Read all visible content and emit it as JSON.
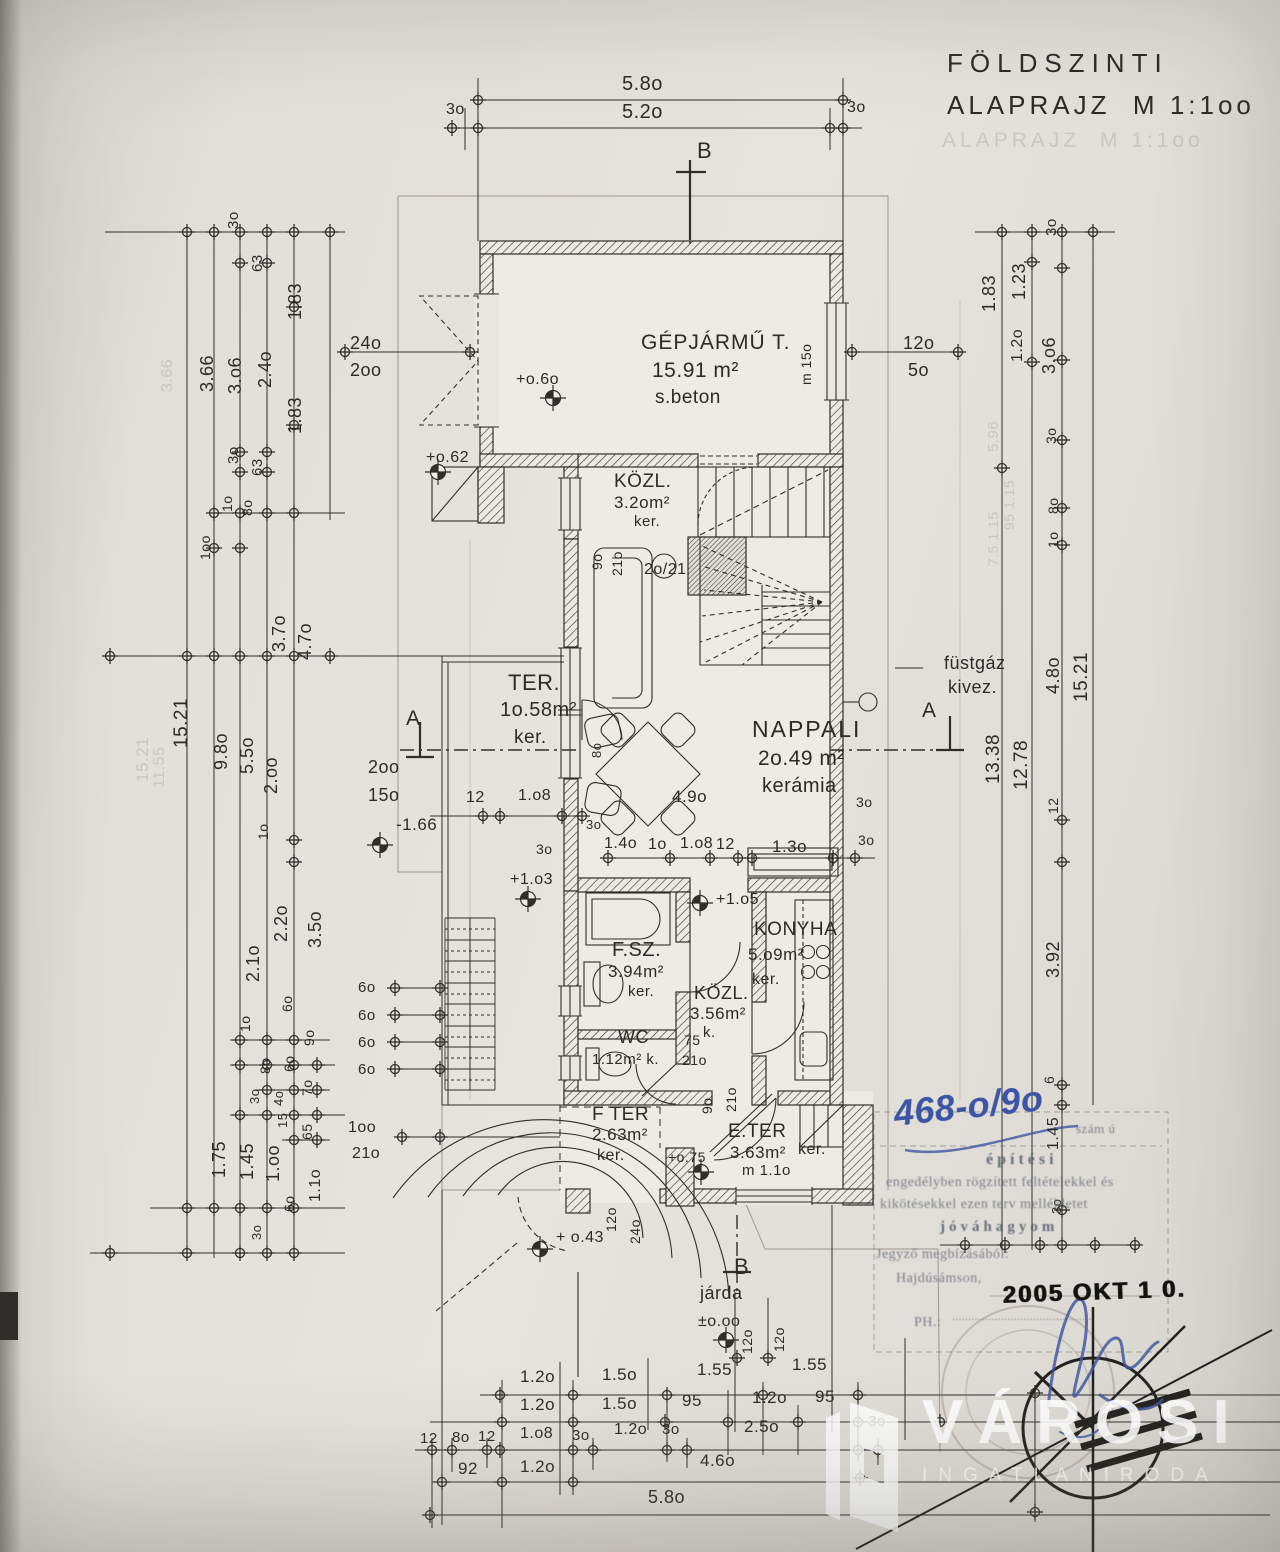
{
  "document": {
    "type": "scanned floor plan",
    "title_line1": "FÖLDSZINTI",
    "title_line2": "ALAPRAJZ  M 1:1oo",
    "scale": "M 1:1oo"
  },
  "rooms": [
    {
      "name": "GÉPJÁRMŰ T.",
      "area": "15.91 m²",
      "floor": "s.beton"
    },
    {
      "name": "KÖZL.",
      "area": "3.2o m²",
      "floor": "ker."
    },
    {
      "name": "TER.",
      "area": "1o.58 m²",
      "floor": "ker."
    },
    {
      "name": "NAPPALI",
      "area": "2o.49 m²",
      "floor": "kerámia"
    },
    {
      "name": "F.SZ.",
      "area": "3.94 m²",
      "floor": "ker."
    },
    {
      "name": "WC",
      "area": "1.12 m²",
      "floor": "k."
    },
    {
      "name": "KÖZL.",
      "area": "3.56 m²",
      "floor": "k."
    },
    {
      "name": "KONYHA",
      "area": "5.o9 m²",
      "floor": "ker."
    },
    {
      "name": "F TER",
      "area": "2.63 m²",
      "floor": "ker."
    },
    {
      "name": "E.TER",
      "area": "3.63 m²",
      "floor": "ker."
    }
  ],
  "levels": [
    "+o.6o",
    "+o.62",
    "+1.o3",
    "+1.o5",
    "+o.75",
    "+ o.43",
    "±o.oo",
    "-1.66"
  ],
  "annotations": [
    "füstgáz kivez.",
    "járda",
    "2o/21",
    "m 15o",
    "m 1.1o"
  ],
  "stamp": {
    "faint_ref": "szám ú",
    "lines": [
      "építési",
      "engedélyben rögzített feltételekkel és",
      "kikötésekkel ezen terv mellékletet",
      "jóváhagyom"
    ],
    "issuer": "Jegyző megbízásából:",
    "city": "Hajdúsámson,",
    "ph": "PH.:",
    "seal_date": "2005 OKT 1 0."
  },
  "handwriting": {
    "file_number": "468-o/9o"
  },
  "watermark": {
    "brand": "VÁROSI",
    "subtitle": "INGATLANIRODA"
  },
  "labels": [
    {
      "t": "FÖLDSZINTI",
      "x": 947,
      "y": 50,
      "s": 26,
      "ls": 7,
      "c": "tt",
      "n": "title-line-1"
    },
    {
      "t": "ALAPRAJZ  M 1:1oo",
      "x": 947,
      "y": 92,
      "s": 26,
      "ls": 4,
      "c": "tt",
      "n": "title-line-2"
    },
    {
      "t": "ALAPRAJZ  M 1:1oo",
      "x": 942,
      "y": 130,
      "s": 21,
      "ls": 4,
      "c": "g2"
    },
    {
      "t": "5.8o",
      "x": 622,
      "y": 74,
      "s": 20
    },
    {
      "t": "3o",
      "x": 446,
      "y": 102,
      "s": 16
    },
    {
      "t": "5.2o",
      "x": 622,
      "y": 102,
      "s": 20
    },
    {
      "t": "3o",
      "x": 847,
      "y": 100,
      "s": 16
    },
    {
      "t": "B",
      "x": 697,
      "y": 140,
      "s": 22
    },
    {
      "t": "GÉPJÁRMŰ T.",
      "x": 641,
      "y": 332,
      "s": 21,
      "ls": 1
    },
    {
      "t": "15.91 m²",
      "x": 652,
      "y": 360,
      "s": 21
    },
    {
      "t": "s.beton",
      "x": 655,
      "y": 388,
      "s": 19
    },
    {
      "t": "+o.6o",
      "x": 516,
      "y": 372,
      "s": 16
    },
    {
      "t": "+o.62",
      "x": 426,
      "y": 450,
      "s": 16
    },
    {
      "t": "24o",
      "x": 350,
      "y": 334,
      "s": 18
    },
    {
      "t": "2oo",
      "x": 350,
      "y": 361,
      "s": 18
    },
    {
      "t": "12o",
      "x": 903,
      "y": 334,
      "s": 18
    },
    {
      "t": "5o",
      "x": 908,
      "y": 361,
      "s": 18
    },
    {
      "t": "m 15o",
      "x": 799,
      "y": 385,
      "s": 14,
      "r": -90
    },
    {
      "t": "3o",
      "x": 226,
      "y": 229,
      "s": 15,
      "r": -90
    },
    {
      "t": "63",
      "x": 250,
      "y": 272,
      "s": 15,
      "r": -90
    },
    {
      "t": "1.83",
      "x": 286,
      "y": 320,
      "s": 18,
      "r": -90
    },
    {
      "t": "3.66",
      "x": 198,
      "y": 392,
      "s": 18,
      "r": -90
    },
    {
      "t": "3.o6",
      "x": 226,
      "y": 394,
      "s": 18,
      "r": -90
    },
    {
      "t": "2.4o",
      "x": 256,
      "y": 388,
      "s": 18,
      "r": -90
    },
    {
      "t": "1.83",
      "x": 286,
      "y": 434,
      "s": 18,
      "r": -90
    },
    {
      "t": "3o",
      "x": 226,
      "y": 464,
      "s": 15,
      "r": -90
    },
    {
      "t": "63",
      "x": 250,
      "y": 476,
      "s": 15,
      "r": -90
    },
    {
      "t": "1o",
      "x": 220,
      "y": 512,
      "s": 14,
      "r": -90
    },
    {
      "t": "8o",
      "x": 240,
      "y": 516,
      "s": 14,
      "r": -90
    },
    {
      "t": "1oo",
      "x": 198,
      "y": 560,
      "s": 14,
      "r": -90
    },
    {
      "t": "3.7o",
      "x": 270,
      "y": 652,
      "s": 18,
      "r": -90
    },
    {
      "t": "4.7o",
      "x": 296,
      "y": 660,
      "s": 18,
      "r": -90
    },
    {
      "t": "15.21",
      "x": 172,
      "y": 748,
      "s": 19,
      "r": -90
    },
    {
      "t": "9.8o",
      "x": 212,
      "y": 770,
      "s": 18,
      "r": -90
    },
    {
      "t": "5.5o",
      "x": 238,
      "y": 774,
      "s": 18,
      "r": -90
    },
    {
      "t": "2.oo",
      "x": 262,
      "y": 794,
      "s": 18,
      "r": -90
    },
    {
      "t": "1o",
      "x": 256,
      "y": 840,
      "s": 14,
      "r": -90
    },
    {
      "t": "2.2o",
      "x": 272,
      "y": 942,
      "s": 18,
      "r": -90
    },
    {
      "t": "3.5o",
      "x": 306,
      "y": 948,
      "s": 18,
      "r": -90
    },
    {
      "t": "2.1o",
      "x": 244,
      "y": 982,
      "s": 18,
      "r": -90
    },
    {
      "t": "6o",
      "x": 280,
      "y": 1012,
      "s": 14,
      "r": -90
    },
    {
      "t": "1o",
      "x": 238,
      "y": 1032,
      "s": 14,
      "r": -90
    },
    {
      "t": "9o",
      "x": 302,
      "y": 1046,
      "s": 14,
      "r": -90
    },
    {
      "t": "8o",
      "x": 258,
      "y": 1074,
      "s": 14,
      "r": -90
    },
    {
      "t": "6o",
      "x": 282,
      "y": 1072,
      "s": 14,
      "r": -90
    },
    {
      "t": "3o",
      "x": 248,
      "y": 1104,
      "s": 13,
      "r": -90
    },
    {
      "t": "4o",
      "x": 272,
      "y": 1106,
      "s": 13,
      "r": -90
    },
    {
      "t": "7o",
      "x": 300,
      "y": 1096,
      "s": 14,
      "r": -90
    },
    {
      "t": "15",
      "x": 276,
      "y": 1128,
      "s": 13,
      "r": -90
    },
    {
      "t": "65",
      "x": 300,
      "y": 1140,
      "s": 14,
      "r": -90
    },
    {
      "t": "1.75",
      "x": 210,
      "y": 1178,
      "s": 18,
      "r": -90
    },
    {
      "t": "1.45",
      "x": 238,
      "y": 1180,
      "s": 18,
      "r": -90
    },
    {
      "t": "1.oo",
      "x": 264,
      "y": 1182,
      "s": 18,
      "r": -90
    },
    {
      "t": "6o",
      "x": 282,
      "y": 1212,
      "s": 14,
      "r": -90
    },
    {
      "t": "1.1o",
      "x": 308,
      "y": 1202,
      "s": 16,
      "r": -90
    },
    {
      "t": "3o",
      "x": 250,
      "y": 1240,
      "s": 13,
      "r": -90
    },
    {
      "t": "2oo",
      "x": 368,
      "y": 758,
      "s": 18
    },
    {
      "t": "15o",
      "x": 368,
      "y": 786,
      "s": 18
    },
    {
      "t": "12",
      "x": 466,
      "y": 790,
      "s": 16
    },
    {
      "t": "1.o8",
      "x": 518,
      "y": 788,
      "s": 16
    },
    {
      "t": "-1.66",
      "x": 396,
      "y": 816,
      "s": 17
    },
    {
      "t": "3o",
      "x": 536,
      "y": 842,
      "s": 14
    },
    {
      "t": "+1.o3",
      "x": 510,
      "y": 872,
      "s": 16
    },
    {
      "t": "6o",
      "x": 358,
      "y": 980,
      "s": 15
    },
    {
      "t": "6o",
      "x": 358,
      "y": 1008,
      "s": 15
    },
    {
      "t": "6o",
      "x": 358,
      "y": 1035,
      "s": 15
    },
    {
      "t": "6o",
      "x": 358,
      "y": 1062,
      "s": 15
    },
    {
      "t": "1oo",
      "x": 348,
      "y": 1120,
      "s": 16
    },
    {
      "t": "21o",
      "x": 352,
      "y": 1146,
      "s": 16
    },
    {
      "t": "KÖZL.",
      "x": 614,
      "y": 472,
      "s": 19
    },
    {
      "t": "3.2om²",
      "x": 614,
      "y": 494,
      "s": 17
    },
    {
      "t": "ker.",
      "x": 634,
      "y": 514,
      "s": 15
    },
    {
      "t": "9o",
      "x": 590,
      "y": 570,
      "s": 14,
      "r": -90
    },
    {
      "t": "21o",
      "x": 610,
      "y": 576,
      "s": 14,
      "r": -90
    },
    {
      "t": "2o/21",
      "x": 644,
      "y": 562,
      "s": 16
    },
    {
      "t": "TER.",
      "x": 508,
      "y": 672,
      "s": 22
    },
    {
      "t": "1o.58m²",
      "x": 500,
      "y": 700,
      "s": 20
    },
    {
      "t": "ker.",
      "x": 514,
      "y": 728,
      "s": 19
    },
    {
      "t": "NAPPALI",
      "x": 752,
      "y": 718,
      "s": 23,
      "ls": 2
    },
    {
      "t": "2o.49 m²",
      "x": 758,
      "y": 748,
      "s": 21
    },
    {
      "t": "kerámia",
      "x": 762,
      "y": 776,
      "s": 20
    },
    {
      "t": "A",
      "x": 406,
      "y": 708,
      "s": 21
    },
    {
      "t": "A",
      "x": 922,
      "y": 700,
      "s": 21
    },
    {
      "t": "füstgáz",
      "x": 944,
      "y": 654,
      "s": 18
    },
    {
      "t": "kivez.",
      "x": 948,
      "y": 678,
      "s": 18
    },
    {
      "t": "8o",
      "x": 590,
      "y": 758,
      "s": 13,
      "r": -90
    },
    {
      "t": "3o",
      "x": 586,
      "y": 818,
      "s": 13
    },
    {
      "t": "4.9o",
      "x": 672,
      "y": 788,
      "s": 17
    },
    {
      "t": "1.4o",
      "x": 604,
      "y": 836,
      "s": 16
    },
    {
      "t": "1o",
      "x": 648,
      "y": 837,
      "s": 16
    },
    {
      "t": "1.o8",
      "x": 680,
      "y": 836,
      "s": 16
    },
    {
      "t": "12",
      "x": 716,
      "y": 837,
      "s": 16
    },
    {
      "t": "1.3o",
      "x": 772,
      "y": 838,
      "s": 17
    },
    {
      "t": "3o",
      "x": 856,
      "y": 795,
      "s": 14
    },
    {
      "t": "3o",
      "x": 858,
      "y": 833,
      "s": 14
    },
    {
      "t": "3o",
      "x": 1044,
      "y": 236,
      "s": 15,
      "r": -90
    },
    {
      "t": "1.83",
      "x": 980,
      "y": 312,
      "s": 18,
      "r": -90
    },
    {
      "t": "1.23",
      "x": 1010,
      "y": 300,
      "s": 18,
      "r": -90
    },
    {
      "t": "1.2o",
      "x": 1010,
      "y": 362,
      "s": 16,
      "r": -90
    },
    {
      "t": "3.o6",
      "x": 1040,
      "y": 374,
      "s": 18,
      "r": -90
    },
    {
      "t": "3o",
      "x": 1044,
      "y": 444,
      "s": 14,
      "r": -90
    },
    {
      "t": "8o",
      "x": 1046,
      "y": 514,
      "s": 14,
      "r": -90
    },
    {
      "t": "1o",
      "x": 1046,
      "y": 548,
      "s": 14,
      "r": -90
    },
    {
      "t": "4.8o",
      "x": 1044,
      "y": 694,
      "s": 18,
      "r": -90
    },
    {
      "t": "15.21",
      "x": 1072,
      "y": 702,
      "s": 19,
      "r": -90
    },
    {
      "t": "13.38",
      "x": 984,
      "y": 784,
      "s": 19,
      "r": -90
    },
    {
      "t": "12.78",
      "x": 1012,
      "y": 790,
      "s": 19,
      "r": -90
    },
    {
      "t": "12",
      "x": 1046,
      "y": 814,
      "s": 14,
      "r": -90
    },
    {
      "t": "3.92",
      "x": 1044,
      "y": 978,
      "s": 18,
      "r": -90
    },
    {
      "t": "6",
      "x": 1042,
      "y": 1084,
      "s": 14,
      "r": -90
    },
    {
      "t": "1.45",
      "x": 1046,
      "y": 1150,
      "s": 16,
      "r": -90
    },
    {
      "t": "3o",
      "x": 1050,
      "y": 1214,
      "s": 13,
      "r": -90
    },
    {
      "t": "+1.o5",
      "x": 716,
      "y": 892,
      "s": 16
    },
    {
      "t": "F.SZ.",
      "x": 612,
      "y": 940,
      "s": 20
    },
    {
      "t": "3.94m²",
      "x": 608,
      "y": 963,
      "s": 17
    },
    {
      "t": "ker.",
      "x": 628,
      "y": 984,
      "s": 15
    },
    {
      "t": "WC",
      "x": 618,
      "y": 1028,
      "s": 18
    },
    {
      "t": "1.12m² k.",
      "x": 592,
      "y": 1052,
      "s": 15
    },
    {
      "t": "KÖZL.",
      "x": 694,
      "y": 984,
      "s": 18
    },
    {
      "t": "3.56m²",
      "x": 690,
      "y": 1005,
      "s": 17
    },
    {
      "t": "k.",
      "x": 703,
      "y": 1025,
      "s": 15
    },
    {
      "t": "75",
      "x": 684,
      "y": 1033,
      "s": 14
    },
    {
      "t": "21o",
      "x": 682,
      "y": 1053,
      "s": 14
    },
    {
      "t": "KONYHA",
      "x": 754,
      "y": 920,
      "s": 19
    },
    {
      "t": "5.o9m²",
      "x": 748,
      "y": 946,
      "s": 17
    },
    {
      "t": "ker.",
      "x": 752,
      "y": 972,
      "s": 16
    },
    {
      "t": "F TER",
      "x": 592,
      "y": 1105,
      "s": 19
    },
    {
      "t": "2.63m²",
      "x": 592,
      "y": 1126,
      "s": 17
    },
    {
      "t": "ker.",
      "x": 597,
      "y": 1148,
      "s": 16
    },
    {
      "t": "E.TER",
      "x": 728,
      "y": 1122,
      "s": 19
    },
    {
      "t": "3.63m²",
      "x": 730,
      "y": 1144,
      "s": 17
    },
    {
      "t": "ker.",
      "x": 798,
      "y": 1142,
      "s": 16
    },
    {
      "t": "m 1.1o",
      "x": 742,
      "y": 1163,
      "s": 15
    },
    {
      "t": "+o.75",
      "x": 668,
      "y": 1150,
      "s": 14
    },
    {
      "t": "9o",
      "x": 700,
      "y": 1114,
      "s": 14,
      "r": -90
    },
    {
      "t": "21o",
      "x": 724,
      "y": 1112,
      "s": 14,
      "r": -90
    },
    {
      "t": "12o",
      "x": 604,
      "y": 1232,
      "s": 14,
      "r": -90
    },
    {
      "t": "24o",
      "x": 628,
      "y": 1244,
      "s": 14,
      "r": -90
    },
    {
      "t": "+ o.43",
      "x": 556,
      "y": 1230,
      "s": 16
    },
    {
      "t": "járda",
      "x": 700,
      "y": 1284,
      "s": 18
    },
    {
      "t": "B",
      "x": 734,
      "y": 1256,
      "s": 22
    },
    {
      "t": "±o.oo",
      "x": 698,
      "y": 1314,
      "s": 16
    },
    {
      "t": "12o",
      "x": 740,
      "y": 1354,
      "s": 14,
      "r": -90
    },
    {
      "t": "12o",
      "x": 772,
      "y": 1352,
      "s": 14,
      "r": -90
    },
    {
      "t": "1.2o",
      "x": 520,
      "y": 1368,
      "s": 17
    },
    {
      "t": "1.5o",
      "x": 602,
      "y": 1366,
      "s": 17
    },
    {
      "t": "1.55",
      "x": 697,
      "y": 1361,
      "s": 17
    },
    {
      "t": "1.55",
      "x": 792,
      "y": 1356,
      "s": 17
    },
    {
      "t": "1.2o",
      "x": 520,
      "y": 1396,
      "s": 17
    },
    {
      "t": "1.5o",
      "x": 602,
      "y": 1395,
      "s": 17
    },
    {
      "t": "95",
      "x": 682,
      "y": 1392,
      "s": 17
    },
    {
      "t": "1.2o",
      "x": 752,
      "y": 1389,
      "s": 17
    },
    {
      "t": "95",
      "x": 815,
      "y": 1388,
      "s": 17
    },
    {
      "t": "12",
      "x": 420,
      "y": 1431,
      "s": 15
    },
    {
      "t": "8o",
      "x": 452,
      "y": 1430,
      "s": 15
    },
    {
      "t": "12",
      "x": 478,
      "y": 1429,
      "s": 15
    },
    {
      "t": "1.o8",
      "x": 520,
      "y": 1426,
      "s": 16
    },
    {
      "t": "3o",
      "x": 572,
      "y": 1428,
      "s": 15
    },
    {
      "t": "1.2o",
      "x": 614,
      "y": 1422,
      "s": 16
    },
    {
      "t": "3o",
      "x": 662,
      "y": 1422,
      "s": 15
    },
    {
      "t": "2.5o",
      "x": 744,
      "y": 1418,
      "s": 17
    },
    {
      "t": "3o",
      "x": 868,
      "y": 1414,
      "s": 15
    },
    {
      "t": "92",
      "x": 458,
      "y": 1460,
      "s": 17
    },
    {
      "t": "1.2o",
      "x": 520,
      "y": 1458,
      "s": 17
    },
    {
      "t": "4.6o",
      "x": 700,
      "y": 1452,
      "s": 17
    },
    {
      "t": "5.8o",
      "x": 648,
      "y": 1488,
      "s": 18
    },
    {
      "t": "szám ú",
      "x": 1076,
      "y": 1122,
      "s": 13,
      "c": "st"
    },
    {
      "t": "építési",
      "x": 986,
      "y": 1152,
      "s": 16,
      "c": "st2",
      "ls": 4
    },
    {
      "t": "engedélyben rögzített feltételekkel és",
      "x": 886,
      "y": 1176,
      "s": 14,
      "c": "st"
    },
    {
      "t": "kikötésekkel ezen terv mellékletet",
      "x": 880,
      "y": 1198,
      "s": 14,
      "c": "st"
    },
    {
      "t": "jóváhagyom",
      "x": 940,
      "y": 1220,
      "s": 15,
      "c": "st2",
      "ls": 4
    },
    {
      "t": "Jegyző megbízásából:",
      "x": 876,
      "y": 1248,
      "s": 14,
      "c": "st"
    },
    {
      "t": "Hajdúsámson,",
      "x": 896,
      "y": 1272,
      "s": 14,
      "c": "st"
    },
    {
      "t": "PH.:",
      "x": 914,
      "y": 1316,
      "s": 14,
      "c": "st"
    },
    {
      "t": "...........................................",
      "x": 952,
      "y": 1312,
      "s": 11,
      "c": "st"
    },
    {
      "t": "2005 OKT 1 0.",
      "x": 1002,
      "y": 1284,
      "s": 24,
      "c": "date",
      "r": -2,
      "n": "date-stamp"
    },
    {
      "t": "468-o/9o",
      "x": 892,
      "y": 1096,
      "s": 36,
      "c": "hand",
      "r": -6,
      "n": "handwritten-file-number"
    },
    {
      "t": "15.21",
      "x": 134,
      "y": 782,
      "s": 17,
      "r": -90,
      "c": "g"
    },
    {
      "t": "11.55",
      "x": 152,
      "y": 788,
      "s": 16,
      "r": -90,
      "c": "g"
    },
    {
      "t": "3.66",
      "x": 160,
      "y": 392,
      "s": 16,
      "r": -90,
      "c": "g"
    },
    {
      "t": "5.96",
      "x": 986,
      "y": 452,
      "s": 15,
      "r": -90,
      "c": "g"
    },
    {
      "t": "95 1.15",
      "x": 1002,
      "y": 530,
      "s": 14,
      "r": -90,
      "c": "g"
    },
    {
      "t": "7.5 1.15",
      "x": 986,
      "y": 566,
      "s": 14,
      "r": -90,
      "c": "g"
    }
  ]
}
